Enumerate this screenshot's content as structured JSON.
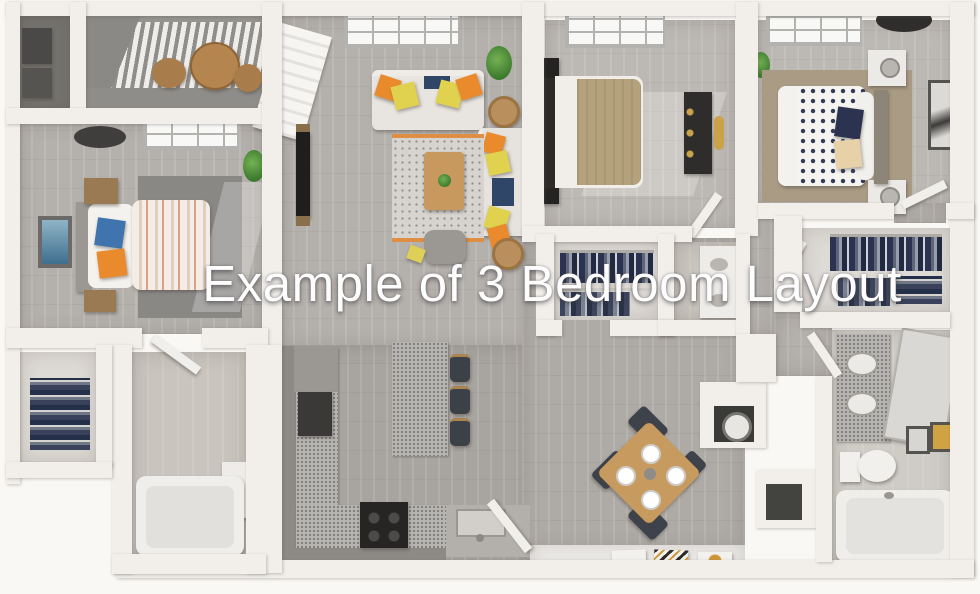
{
  "title": {
    "text": "Example of 3 Bedroom Layout"
  },
  "scene": {
    "kind": "3d-floor-plan-render",
    "unit": "3 bedroom apartment"
  },
  "palette": {
    "background": "#faf8f5",
    "wall": "#f2efeb",
    "floor_wood": "#b4b0ac",
    "floor_dark": "#76746f",
    "granite_counter": "#b7b5b1",
    "cabinet_gray": "#8d8a85",
    "furniture_wood": "#c79a5f",
    "accent_orange": "#e98a2c",
    "accent_yellow": "#e0d24e",
    "accent_blue": "#3f74ae",
    "navy": "#2b3350",
    "tan_bedding": "#b5a27c",
    "white_furniture": "#f1eee9",
    "title_text": "#fdfdfd"
  }
}
